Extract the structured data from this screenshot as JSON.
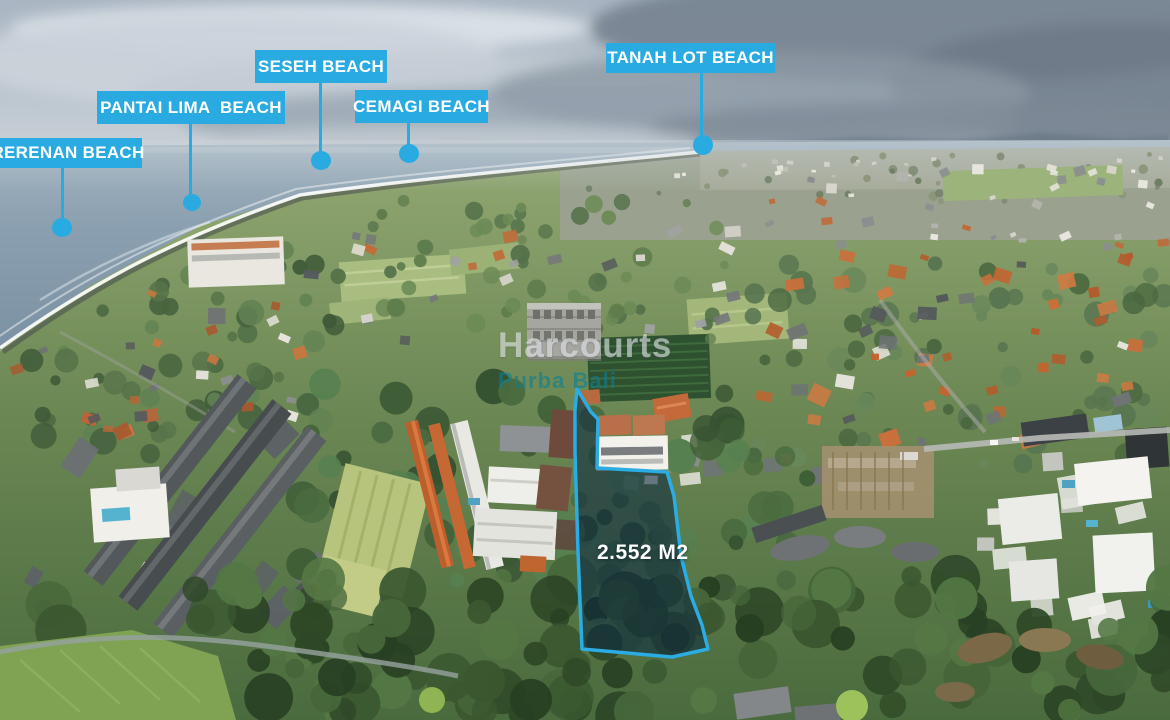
{
  "beach_markers": [
    {
      "label": "RERENAN BEACH"
    },
    {
      "label": "PANTAI LIMA  BEACH"
    },
    {
      "label": "SESEH BEACH"
    },
    {
      "label": "CEMAGI BEACH"
    },
    {
      "label": "TANAH LOT BEACH"
    }
  ],
  "plot": {
    "area_label": "2.552 M2",
    "outline_color": "#2bace3",
    "fill_color": "rgba(9,38,66,0.55)"
  },
  "watermark": {
    "brand": "Harcourts",
    "subbrand": "Purba Bali"
  },
  "colors": {
    "marker_blue": "#29abe2",
    "marker_text": "#ffffff",
    "plot_area_text": "#ffffff"
  }
}
